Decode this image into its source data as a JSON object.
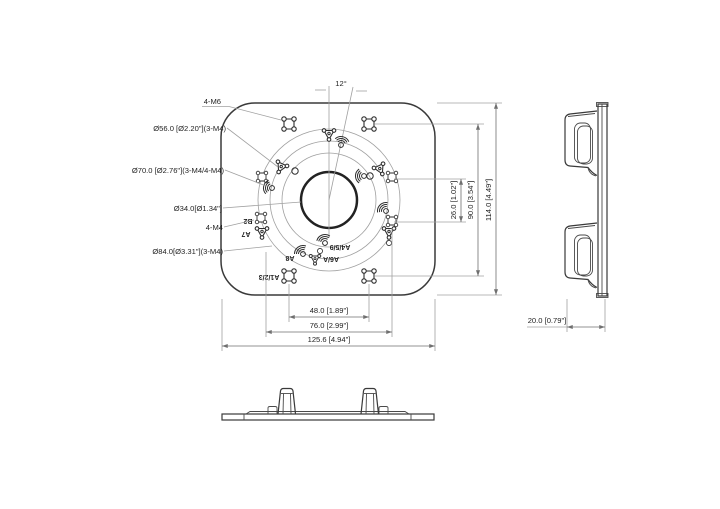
{
  "front": {
    "callouts": {
      "m6": "4-M6",
      "d56": "Ø56.0 [Ø2.20\"](3-M4)",
      "d70": "Ø70.0 [Ø2.76\"](3-M4/4-M4)",
      "d34": "Ø34.0[Ø1.34\"]",
      "m4": "4-M4",
      "d84": "Ø84.0[Ø3.31\"](3-M4)",
      "angle": "12°"
    },
    "hole_tags": {
      "b2": "B2",
      "a7": "A7",
      "a8": "A8",
      "a6a": "A6/A",
      "a459": "A4/5/9",
      "a123": "A1/2/3"
    },
    "dims": {
      "w48": "48.0 [1.89\"]",
      "w76": "76.0 [2.99\"]",
      "w1256": "125.6 [4.94\"]",
      "h26": "26.0 [1.02\"]",
      "h90": "90.0 [3.54\"]",
      "h114": "114.0 [4.49\"]"
    }
  },
  "side": {
    "depth": "20.0 [0.79\"]"
  },
  "colors": {
    "background": "#ffffff",
    "line_dark": "#3a3a3a",
    "line_thin": "#a0a0a0",
    "line_dim": "#6f6f6f",
    "text": "#1f1f1f"
  }
}
